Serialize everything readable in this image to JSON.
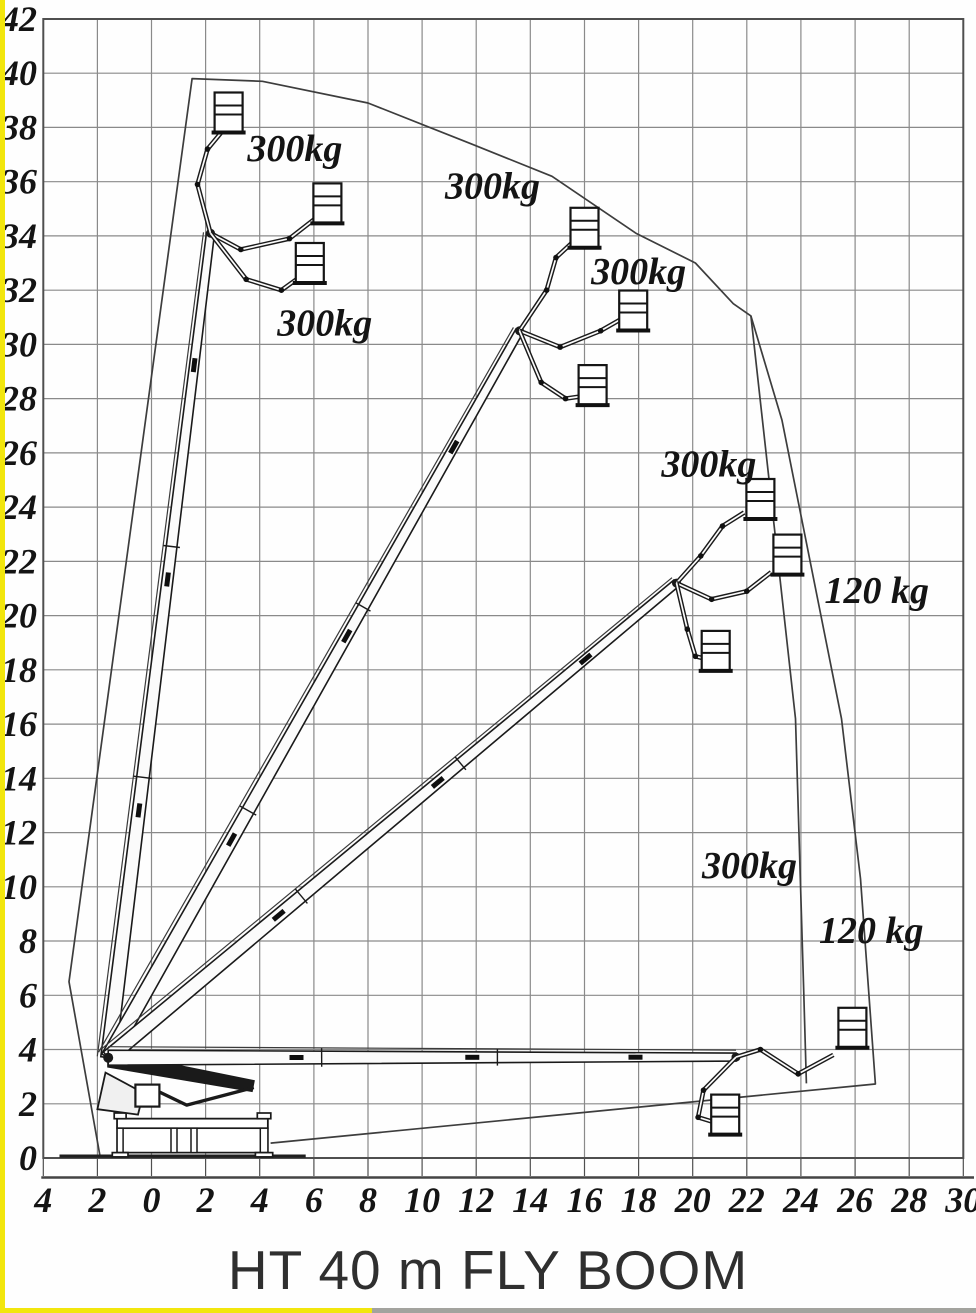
{
  "window": {
    "title": "HT 40 m FLY BOOM"
  },
  "palette": {
    "paper": "#fefefe",
    "border_yellow": "#f2e60d",
    "border_gray": "#a3a39e",
    "grid_line": "#8a8a8a",
    "grid_border": "#4f4f4f",
    "ink": "#1a1a1a",
    "envelope": "#3d3d3d",
    "label_ink": "#141414",
    "title_ink": "#2f2f2f"
  },
  "chart_data": {
    "type": "working-envelope-diagram",
    "title": "HT 40 m FLY BOOM",
    "grid_step_m": 2,
    "x_axis": {
      "range_m": [
        -4,
        30
      ],
      "tick_values_m": [
        -4,
        -2,
        0,
        2,
        4,
        6,
        8,
        10,
        12,
        14,
        16,
        18,
        20,
        22,
        24,
        26,
        28,
        30
      ],
      "tick_labels": [
        "4",
        "2",
        "0",
        "2",
        "4",
        "6",
        "8",
        "10",
        "12",
        "14",
        "16",
        "18",
        "20",
        "22",
        "24",
        "26",
        "28",
        "30"
      ]
    },
    "y_axis": {
      "range_m": [
        0,
        42
      ],
      "tick_values_m": [
        42,
        40,
        38,
        36,
        34,
        32,
        30,
        28,
        26,
        24,
        22,
        20,
        18,
        16,
        14,
        12,
        10,
        8,
        6,
        4,
        2,
        0
      ],
      "tick_labels": [
        "42",
        "40",
        "38",
        "36",
        "34",
        "32",
        "30",
        "28",
        "26",
        "24",
        "22",
        "20",
        "18",
        "16",
        "14",
        "12",
        "10",
        "8",
        "6",
        "4",
        "2",
        "0"
      ]
    },
    "pivot_m": [
      -1.6,
      3.7
    ],
    "outer_envelope_m": [
      [
        -1.9,
        0.05
      ],
      [
        -3.05,
        6.5
      ],
      [
        1.5,
        39.8
      ],
      [
        4.1,
        39.7
      ],
      [
        8.0,
        38.9
      ],
      [
        11.8,
        37.4
      ],
      [
        14.8,
        36.2
      ],
      [
        17.9,
        34.1
      ],
      [
        20.1,
        33.0
      ],
      [
        21.5,
        31.5
      ],
      [
        22.15,
        31.05
      ],
      [
        23.3,
        27.2
      ],
      [
        25.5,
        16.2
      ],
      [
        26.2,
        10.3
      ],
      [
        26.75,
        2.73
      ],
      [
        4.4,
        0.55
      ]
    ],
    "inner_boundary_300kg_m": [
      [
        22.15,
        31.05
      ],
      [
        23.8,
        16.2
      ],
      [
        24.1,
        6.3
      ],
      [
        24.2,
        2.75
      ]
    ],
    "load_labels": [
      {
        "text": "300kg",
        "x_m": 5.3,
        "y_m": 37.25
      },
      {
        "text": "300kg",
        "x_m": 12.6,
        "y_m": 35.85
      },
      {
        "text": "300kg",
        "x_m": 6.4,
        "y_m": 30.8
      },
      {
        "text": "300kg",
        "x_m": 18.0,
        "y_m": 32.7
      },
      {
        "text": "300kg",
        "x_m": 20.6,
        "y_m": 25.6
      },
      {
        "text": "120 kg",
        "x_m": 26.8,
        "y_m": 20.95
      },
      {
        "text": "300kg",
        "x_m": 22.1,
        "y_m": 10.8
      },
      {
        "text": "120 kg",
        "x_m": 26.6,
        "y_m": 8.4
      }
    ],
    "boom_positions": [
      {
        "name": "boom-vertical",
        "head_m": [
          2.18,
          34.1
        ],
        "jibs": [
          {
            "path_m": [
              [
                2.18,
                34.1
              ],
              [
                1.7,
                35.9
              ],
              [
                2.07,
                37.2
              ],
              [
                2.65,
                37.9
              ]
            ],
            "basket_m": [
              2.85,
              38.55
            ]
          },
          {
            "path_m": [
              [
                2.18,
                34.1
              ],
              [
                3.3,
                33.5
              ],
              [
                5.1,
                33.9
              ],
              [
                6.0,
                34.6
              ]
            ],
            "basket_m": [
              6.5,
              35.2
            ]
          },
          {
            "path_m": [
              [
                2.18,
                34.1
              ],
              [
                3.5,
                32.4
              ],
              [
                4.8,
                32.0
              ],
              [
                5.5,
                32.5
              ]
            ],
            "basket_m": [
              5.85,
              33.0
            ]
          }
        ]
      },
      {
        "name": "boom-steep",
        "head_m": [
          13.6,
          30.5
        ],
        "jibs": [
          {
            "path_m": [
              [
                13.6,
                30.5
              ],
              [
                14.6,
                32.0
              ],
              [
                14.95,
                33.2
              ],
              [
                15.6,
                33.8
              ]
            ],
            "basket_m": [
              16.0,
              34.3
            ]
          },
          {
            "path_m": [
              [
                13.6,
                30.5
              ],
              [
                15.1,
                29.9
              ],
              [
                16.6,
                30.5
              ],
              [
                17.3,
                30.9
              ]
            ],
            "basket_m": [
              17.8,
              31.25
            ]
          },
          {
            "path_m": [
              [
                13.6,
                30.5
              ],
              [
                14.4,
                28.6
              ],
              [
                15.3,
                28.0
              ],
              [
                16.0,
                28.1
              ]
            ],
            "basket_m": [
              16.3,
              28.5
            ]
          }
        ]
      },
      {
        "name": "boom-mid",
        "head_m": [
          19.4,
          21.2
        ],
        "jibs": [
          {
            "path_m": [
              [
                19.4,
                21.2
              ],
              [
                20.3,
                22.2
              ],
              [
                21.1,
                23.3
              ],
              [
                21.9,
                23.8
              ]
            ],
            "basket_m": [
              22.5,
              24.3
            ]
          },
          {
            "path_m": [
              [
                19.4,
                21.2
              ],
              [
                20.7,
                20.6
              ],
              [
                22.0,
                20.9
              ],
              [
                22.9,
                21.6
              ]
            ],
            "basket_m": [
              23.5,
              22.25
            ]
          },
          {
            "path_m": [
              [
                19.4,
                21.2
              ],
              [
                19.8,
                19.5
              ],
              [
                20.1,
                18.5
              ],
              [
                20.5,
                18.4
              ]
            ],
            "basket_m": [
              20.85,
              18.7
            ]
          }
        ]
      },
      {
        "name": "boom-horizontal",
        "head_m": [
          21.6,
          3.72
        ],
        "jibs": [
          {
            "path_m": [
              [
                21.6,
                3.72
              ],
              [
                22.5,
                4.0
              ],
              [
                23.9,
                3.1
              ],
              [
                25.2,
                3.8
              ]
            ],
            "basket_m": [
              25.9,
              4.8
            ]
          },
          {
            "path_m": [
              [
                21.6,
                3.72
              ],
              [
                20.4,
                2.5
              ],
              [
                20.2,
                1.5
              ],
              [
                20.7,
                1.35
              ]
            ],
            "basket_m": [
              21.2,
              1.6
            ]
          }
        ]
      }
    ],
    "base_machine": {
      "ground_line_m": [
        [
          -3.4,
          0.07
        ],
        [
          5.7,
          0.07
        ]
      ],
      "chassis_rect_m": {
        "x1": -1.27,
        "y1": 0.2,
        "x2": 4.3,
        "y2": 1.45
      },
      "top_rail_m": {
        "x1": -1.27,
        "y1": 1.1,
        "x2": 4.3,
        "y2": 1.45
      },
      "posts_x_m": [
        [
          -1.27,
          -1.05
        ],
        [
          0.72,
          0.94
        ],
        [
          1.46,
          1.68
        ],
        [
          4.02,
          4.3
        ]
      ],
      "post_y_m": [
        0.2,
        1.1
      ],
      "caps_m": [
        {
          "x1": -1.38,
          "y1": 1.45,
          "x2": -0.94,
          "y2": 1.66
        },
        {
          "x1": 3.91,
          "y1": 1.45,
          "x2": 4.41,
          "y2": 1.66
        }
      ],
      "feet_m": [
        {
          "x1": -1.45,
          "y1": 0.04,
          "x2": -0.87,
          "y2": 0.2
        },
        {
          "x1": 3.84,
          "y1": 0.04,
          "x2": 4.48,
          "y2": 0.2
        }
      ],
      "turret_poly_m": [
        [
          -2.0,
          1.8
        ],
        [
          -0.5,
          1.6
        ],
        [
          -0.3,
          2.4
        ],
        [
          -1.7,
          3.15
        ]
      ],
      "stowed_boom_poly_m": [
        [
          -1.62,
          3.95
        ],
        [
          3.8,
          2.85
        ],
        [
          3.72,
          2.45
        ],
        [
          -1.62,
          3.35
        ]
      ],
      "folded_jib_path_m": [
        [
          3.78,
          2.6
        ],
        [
          1.3,
          1.95
        ],
        [
          -0.05,
          2.6
        ]
      ],
      "stowed_basket_m": [
        -0.15,
        2.3
      ]
    }
  }
}
